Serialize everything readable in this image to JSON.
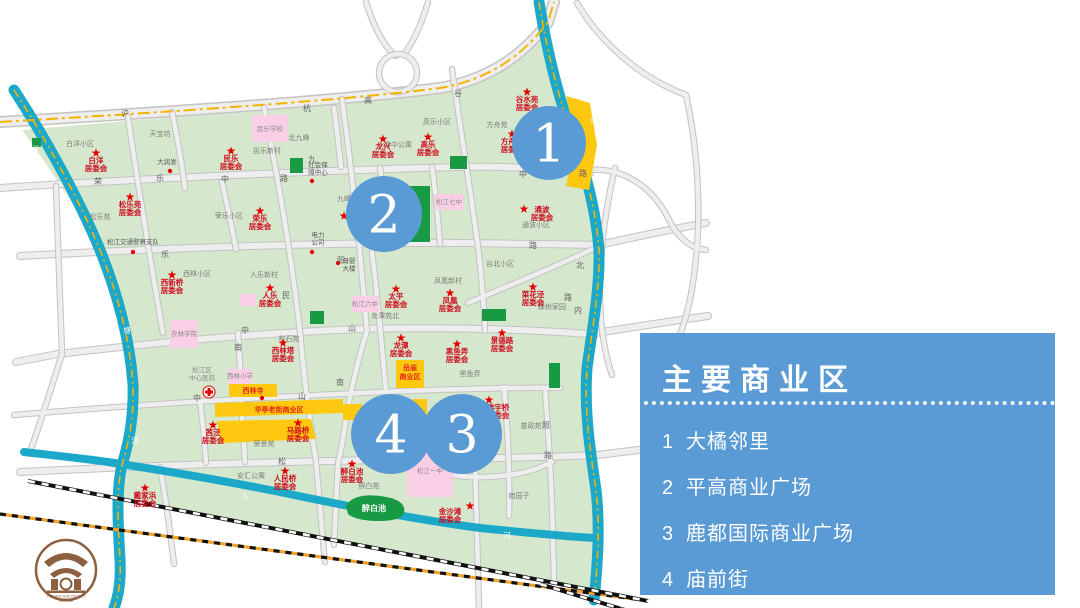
{
  "legend": {
    "title": "主要商业区",
    "items": [
      {
        "num": "1",
        "label": "大橘邻里"
      },
      {
        "num": "2",
        "label": "平高商业广场"
      },
      {
        "num": "3",
        "label": "鹿都国际商业广场"
      },
      {
        "num": "4",
        "label": "庙前街"
      }
    ]
  },
  "colors": {
    "panel": "#5b9bd5",
    "marker": "#5b9bd5",
    "land": "#d5e8cd",
    "park": "#189a44",
    "water": "#1ca9c9",
    "roadFill": "#eeeeee",
    "roadEdge": "#c3c3c3",
    "dash": "#f5b301",
    "pink": "#f9cfe6",
    "yellow": "#ffc810",
    "red": "#e60000",
    "committee": "#cf0a1e",
    "railOrange": "#f0a22e",
    "brown": "#8d5f3f"
  },
  "map": {
    "markers": [
      {
        "n": "1",
        "x": 549,
        "y": 143,
        "r": 37
      },
      {
        "n": "2",
        "x": 384,
        "y": 214,
        "r": 38
      },
      {
        "n": "4",
        "x": 391,
        "y": 434,
        "r": 40
      },
      {
        "n": "3",
        "x": 462,
        "y": 434,
        "r": 40
      }
    ],
    "areas": [
      {
        "t": "白洋小区",
        "x": 80,
        "y": 146
      },
      {
        "t": "天宝坊",
        "x": 160,
        "y": 136
      },
      {
        "t": "民乐新村",
        "x": 267,
        "y": 153
      },
      {
        "t": "北九峰",
        "x": 299,
        "y": 140
      },
      {
        "t": "华中公寓",
        "x": 398,
        "y": 147
      },
      {
        "t": "高乐小区",
        "x": 437,
        "y": 124
      },
      {
        "t": "方舟苑",
        "x": 497,
        "y": 127
      },
      {
        "t": "松乐苑",
        "x": 100,
        "y": 219
      },
      {
        "t": "荣乐小区",
        "x": 229,
        "y": 218
      },
      {
        "t": "九峰",
        "x": 344,
        "y": 201
      },
      {
        "t": "通波小区",
        "x": 536,
        "y": 227
      },
      {
        "t": "谷北小区",
        "x": 500,
        "y": 266
      },
      {
        "t": "西林小区",
        "x": 197,
        "y": 276
      },
      {
        "t": "人乐新村",
        "x": 264,
        "y": 277
      },
      {
        "t": "凤凰新村",
        "x": 448,
        "y": 283
      },
      {
        "t": "龙潭苑北",
        "x": 385,
        "y": 318
      },
      {
        "t": "松石苑",
        "x": 289,
        "y": 341
      },
      {
        "t": "黑鱼弄",
        "x": 470,
        "y": 376
      },
      {
        "t": "橡树家园",
        "x": 552,
        "y": 309
      },
      {
        "t": "荣景苑",
        "x": 264,
        "y": 446
      },
      {
        "t": "南园子",
        "x": 519,
        "y": 498
      },
      {
        "t": "普政苑",
        "x": 531,
        "y": 428
      },
      {
        "t": "醉白苑",
        "x": 369,
        "y": 488
      },
      {
        "t": "安汇公寓",
        "x": 251,
        "y": 478
      }
    ],
    "committees": [
      {
        "x": 96,
        "y": 153,
        "l": [
          "白洋",
          "居委会"
        ]
      },
      {
        "x": 231,
        "y": 151,
        "l": [
          "民乐",
          "居委会"
        ]
      },
      {
        "x": 383,
        "y": 139,
        "l": [
          "龙兴",
          "居委会"
        ]
      },
      {
        "x": 428,
        "y": 137,
        "l": [
          "高乐",
          "居委会"
        ]
      },
      {
        "x": 512,
        "y": 134,
        "l": [
          "方舟苑",
          "居委会"
        ]
      },
      {
        "x": 527,
        "y": 92,
        "l": [
          "谷水苑",
          "居委会"
        ]
      },
      {
        "x": 130,
        "y": 197,
        "l": [
          "松乐苑",
          "居委会"
        ]
      },
      {
        "x": 260,
        "y": 211,
        "l": [
          "荣乐",
          "居委会"
        ]
      },
      {
        "x": 524,
        "y": 209,
        "tx": 542,
        "ty": 212,
        "l": [
          "通波",
          "居委会"
        ]
      },
      {
        "x": 172,
        "y": 275,
        "l": [
          "西新桥",
          "居委会"
        ]
      },
      {
        "x": 270,
        "y": 288,
        "l": [
          "人乐",
          "居委会"
        ]
      },
      {
        "x": 396,
        "y": 289,
        "l": [
          "太平",
          "居委会"
        ]
      },
      {
        "x": 450,
        "y": 293,
        "l": [
          "凤凰",
          "居委会"
        ]
      },
      {
        "x": 533,
        "y": 287,
        "l": [
          "菜花泾",
          "居委会"
        ]
      },
      {
        "x": 283,
        "y": 343,
        "l": [
          "西林塔",
          "居委会"
        ]
      },
      {
        "x": 502,
        "y": 333,
        "l": [
          "景德路",
          "居委会"
        ]
      },
      {
        "x": 457,
        "y": 344,
        "l": [
          "黑鱼弄",
          "居委会"
        ]
      },
      {
        "x": 401,
        "y": 338,
        "l": [
          "龙潭",
          "居委会"
        ]
      },
      {
        "x": 213,
        "y": 425,
        "l": [
          "茜泾",
          "居委会"
        ]
      },
      {
        "x": 298,
        "y": 423,
        "l": [
          "马路桥",
          "居委会"
        ]
      },
      {
        "x": 285,
        "y": 471,
        "l": [
          "人民桥",
          "居委会"
        ]
      },
      {
        "x": 352,
        "y": 464,
        "l": [
          "醉白池",
          "居委会"
        ]
      },
      {
        "x": 470,
        "y": 506,
        "tx": 450,
        "ty": 514,
        "l": [
          "金沙滩",
          "居委会"
        ]
      },
      {
        "x": 145,
        "y": 488,
        "l": [
          "戴家浜",
          "居委会"
        ]
      },
      {
        "x": 489,
        "y": 400,
        "tx": 498,
        "ty": 410,
        "l": [
          "佛宇桥",
          "居委会"
        ]
      },
      {
        "x": 344,
        "y": 216,
        "l": []
      }
    ],
    "pois": [
      {
        "lines": [
          "大润发"
        ],
        "x": 167,
        "y": 164,
        "dx": 170,
        "dy": 171
      },
      {
        "lines": [
          "松江交通警察支队"
        ],
        "x": 133,
        "y": 244,
        "dx": 133,
        "dy": 252
      },
      {
        "lines": [
          "社会保",
          "障中心"
        ],
        "x": 318,
        "y": 167,
        "dx": 312,
        "dy": 181
      },
      {
        "lines": [
          "电力",
          "公司"
        ],
        "x": 318,
        "y": 237,
        "dx": 312,
        "dy": 252
      },
      {
        "lines": [
          "母婴",
          "大楼"
        ],
        "x": 349,
        "y": 263,
        "dx": 338,
        "dy": 263
      }
    ],
    "roadChars": [
      {
        "t": "沪",
        "x": 125,
        "y": 116
      },
      {
        "t": "杭",
        "x": 307,
        "y": 111
      },
      {
        "t": "高",
        "x": 368,
        "y": 103
      },
      {
        "t": "荣",
        "x": 98,
        "y": 184
      },
      {
        "t": "乐",
        "x": 160,
        "y": 181
      },
      {
        "t": "中",
        "x": 225,
        "y": 182
      },
      {
        "t": "路",
        "x": 284,
        "y": 181
      },
      {
        "t": "中",
        "x": 523,
        "y": 177
      },
      {
        "t": "路",
        "x": 583,
        "y": 176
      },
      {
        "t": "乐",
        "x": 165,
        "y": 257
      },
      {
        "t": "路",
        "x": 533,
        "y": 248
      },
      {
        "t": "阳",
        "x": 341,
        "y": 263
      },
      {
        "t": "九",
        "x": 312,
        "y": 162
      },
      {
        "t": "谷",
        "x": 458,
        "y": 96
      },
      {
        "t": "民",
        "x": 286,
        "y": 298
      },
      {
        "t": "中",
        "x": 245,
        "y": 333
      },
      {
        "t": "山",
        "x": 352,
        "y": 331
      },
      {
        "t": "中",
        "x": 197,
        "y": 401
      },
      {
        "t": "山",
        "x": 302,
        "y": 399
      },
      {
        "t": "南",
        "x": 238,
        "y": 350
      },
      {
        "t": "南",
        "x": 340,
        "y": 385
      },
      {
        "t": "松",
        "x": 282,
        "y": 464
      },
      {
        "t": "中",
        "x": 455,
        "y": 470
      },
      {
        "t": "路",
        "x": 548,
        "y": 458
      },
      {
        "t": "照",
        "x": 546,
        "y": 428
      },
      {
        "t": "北",
        "x": 580,
        "y": 268
      },
      {
        "t": "内",
        "x": 578,
        "y": 313
      },
      {
        "t": "路",
        "x": 568,
        "y": 300
      }
    ],
    "riverChars": [
      {
        "t": "沙",
        "x": 36,
        "y": 151
      },
      {
        "t": "塘",
        "x": 127,
        "y": 333
      },
      {
        "t": "泾",
        "x": 135,
        "y": 443
      },
      {
        "t": "市",
        "x": 86,
        "y": 419
      },
      {
        "t": "河",
        "x": 104,
        "y": 418
      },
      {
        "t": "人",
        "x": 245,
        "y": 499
      },
      {
        "t": "河",
        "x": 507,
        "y": 538
      },
      {
        "t": "通",
        "x": 594,
        "y": 123
      }
    ],
    "parks": [
      [
        408,
        186,
        22,
        56
      ],
      [
        290,
        158,
        13,
        15
      ],
      [
        450,
        156,
        17,
        13
      ],
      [
        310,
        311,
        14,
        13
      ],
      [
        482,
        309,
        24,
        12
      ],
      [
        549,
        363,
        11,
        25
      ],
      [
        32,
        138,
        9,
        9
      ]
    ],
    "pondLabel": {
      "t": "醉白池",
      "x": 374,
      "y": 511
    },
    "schools": [
      {
        "x": 252,
        "y": 115,
        "w": 36,
        "h": 27,
        "t": "民乐学校",
        "lx": 270,
        "ly": 131
      },
      {
        "x": 434,
        "y": 194,
        "w": 30,
        "h": 16,
        "t": "松江七中",
        "lx": 449,
        "ly": 204
      },
      {
        "x": 352,
        "y": 296,
        "w": 27,
        "h": 16,
        "t": "松江六中",
        "lx": 365,
        "ly": 306
      },
      {
        "x": 170,
        "y": 320,
        "w": 28,
        "h": 28,
        "t": "农林学院",
        "lx": 184,
        "ly": 336
      },
      {
        "x": 228,
        "y": 369,
        "w": 24,
        "h": 15,
        "t": "西林小学",
        "lx": 240,
        "ly": 378
      },
      {
        "x": 407,
        "y": 445,
        "w": 46,
        "h": 52,
        "t": "松江一中",
        "lx": 430,
        "ly": 473
      },
      {
        "x": 240,
        "y": 294,
        "w": 16,
        "h": 12,
        "t": "",
        "lx": 0,
        "ly": 0
      }
    ],
    "commercial": [
      {
        "x": 396,
        "y": 360,
        "w": 28,
        "h": 28
      },
      {
        "x": 229,
        "y": 384,
        "w": 48,
        "h": 13
      },
      {
        "x": 343,
        "y": 404,
        "w": 19,
        "h": 16
      },
      {
        "x": 413,
        "y": 399,
        "w": 14,
        "h": 28
      }
    ],
    "bizLabels": [
      {
        "lines": [
          "岳庙",
          "商业区"
        ],
        "x": 410,
        "y": 370
      },
      {
        "lines": [
          "西林寺"
        ],
        "x": 253,
        "y": 393
      },
      {
        "lines": [
          "华亭老街商业区"
        ],
        "x": 279,
        "y": 412
      }
    ],
    "dots": [
      {
        "x": 262,
        "y": 398
      }
    ],
    "hospital": {
      "x": 209,
      "y": 392,
      "lines": [
        "松江区",
        "中心医院"
      ],
      "lx": 202,
      "ly": 372
    }
  },
  "logo": {
    "line1": "YUEYANG SUB-DISTRICT",
    "line2": "岳阳·街道"
  }
}
